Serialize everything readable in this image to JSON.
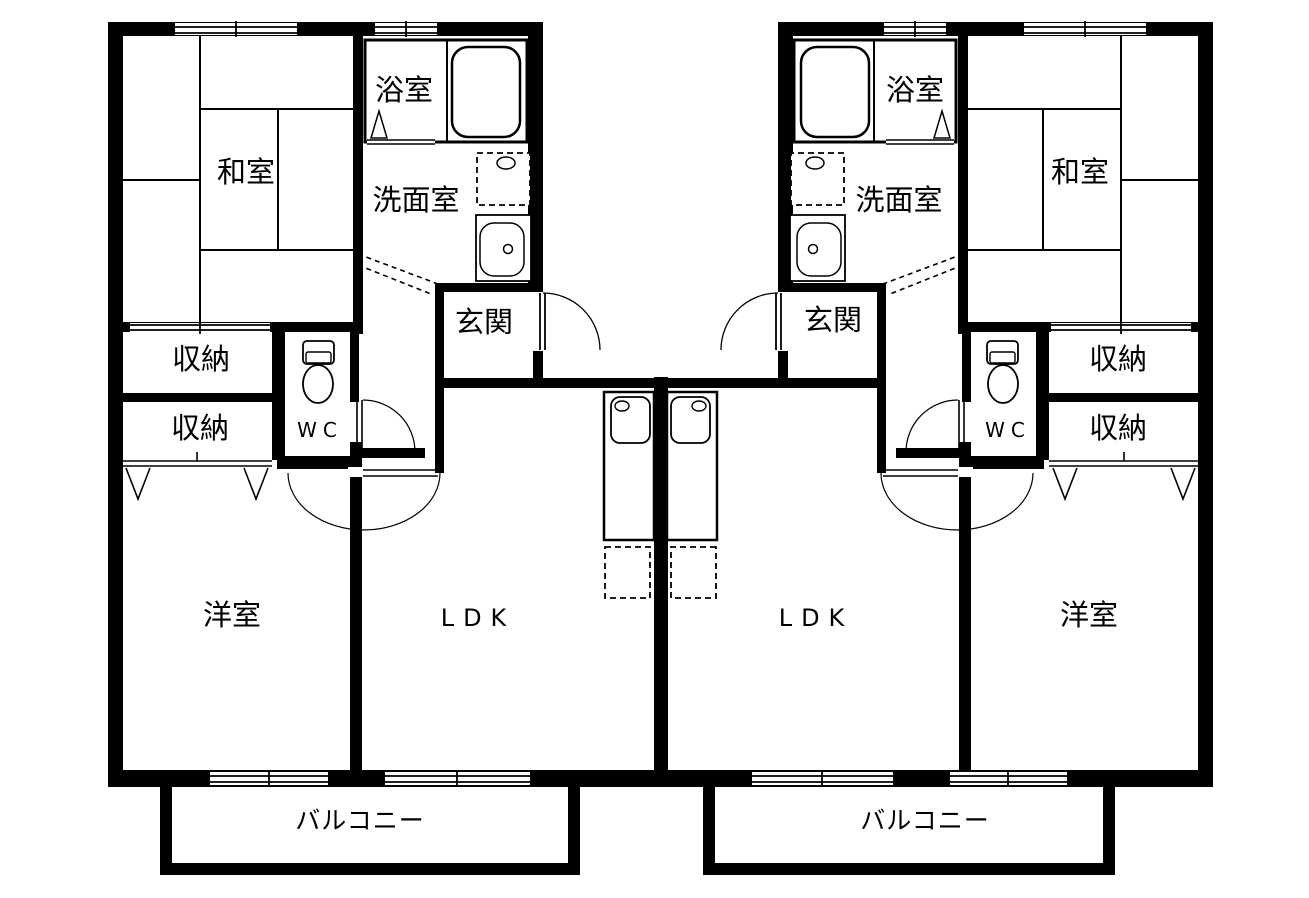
{
  "floor_plan": {
    "colors": {
      "line": "#000000",
      "background": "#ffffff"
    },
    "icons": {
      "bathtub": "rounded-rect",
      "toilet": "tank-and-bowl",
      "vanity_sink": "basin-with-drain",
      "washer_pan": "dashed-square-with-faucet",
      "kitchen_sink": "counter-with-basin",
      "refrigerator_space": "dashed-square",
      "door_swing": "quarter-arc",
      "window": "double-line-band",
      "closet_door": "chevron-v"
    },
    "units": [
      {
        "id": "left",
        "rooms": {
          "washitsu": "和室",
          "bathroom": "浴室",
          "washroom": "洗面室",
          "entrance": "玄関",
          "storage_upper": "収納",
          "storage_lower": "収納",
          "wc": "WC",
          "western_room": "洋室",
          "ldk": "LDK",
          "balcony": "バルコニー"
        }
      },
      {
        "id": "right",
        "rooms": {
          "washitsu": "和室",
          "bathroom": "浴室",
          "washroom": "洗面室",
          "entrance": "玄関",
          "storage_upper": "収納",
          "storage_lower": "収納",
          "wc": "WC",
          "western_room": "洋室",
          "ldk": "LDK",
          "balcony": "バルコニー"
        }
      }
    ]
  }
}
